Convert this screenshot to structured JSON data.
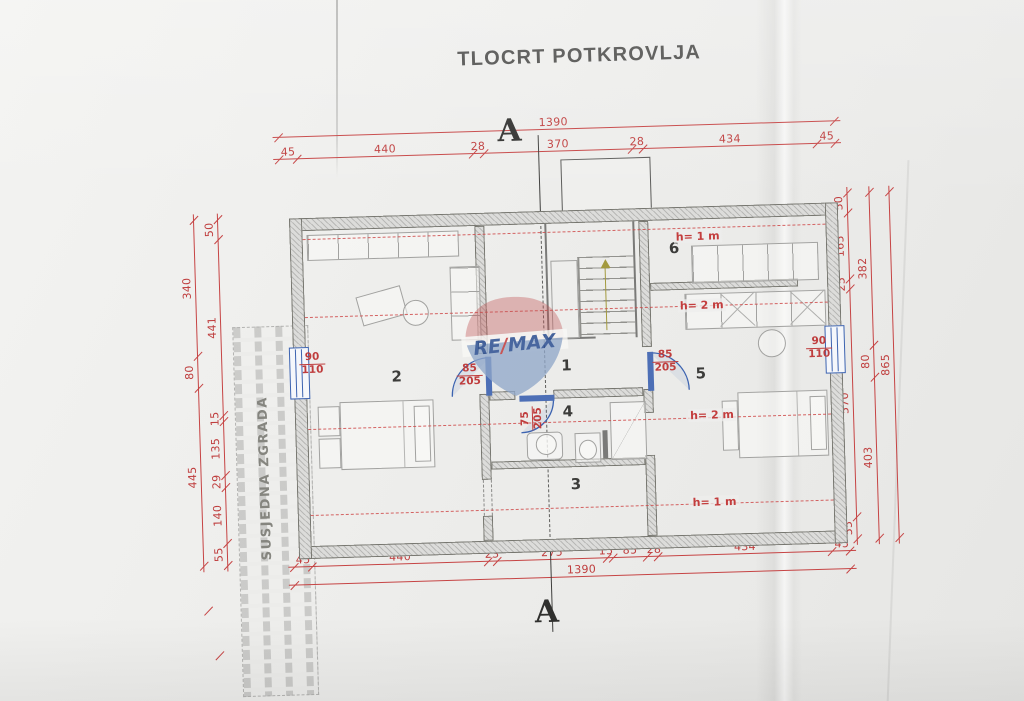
{
  "title": "TLOCRT POTKROVLJA",
  "section": {
    "top": "A",
    "bottom": "A"
  },
  "neighbor": {
    "label": "SUSJEDNA ZGRADA"
  },
  "watermark": {
    "re": "RE",
    "slash": "/",
    "max": "MAX"
  },
  "rooms": {
    "r1": "1",
    "r2": "2",
    "r3": "3",
    "r4": "4",
    "r5": "5",
    "r6": "6"
  },
  "heights": {
    "h1": "h= 1 m",
    "h2": "h= 2 m",
    "h3": "h= 2 m",
    "h4": "h= 1 m"
  },
  "dims": {
    "top": {
      "total": "1390",
      "segments": [
        "45",
        "440",
        "28",
        "370",
        "28",
        "434",
        "45"
      ]
    },
    "bottom": {
      "total": "1390",
      "segments": [
        "45",
        "440",
        "23",
        "275",
        "15",
        "85",
        "28",
        "434",
        "45"
      ]
    },
    "left": {
      "outer": [
        "340",
        "80",
        "445"
      ],
      "inner": [
        "50",
        "441",
        "15",
        "135",
        "29",
        "140",
        "55"
      ]
    },
    "right": {
      "inner": [
        "50",
        "165",
        "25",
        "570",
        "55"
      ],
      "middle": [
        "382",
        "80",
        "403"
      ],
      "total": "865"
    }
  },
  "openings": {
    "window_left": {
      "w": "90",
      "h": "110"
    },
    "window_right": {
      "w": "90",
      "h": "110"
    },
    "door_room2": {
      "w": "85",
      "h": "205"
    },
    "door_room5": {
      "w": "85",
      "h": "205"
    },
    "door_room4": {
      "w": "75",
      "h": "205"
    }
  },
  "colors": {
    "dimension_red": "#c64444",
    "opening_blue": "#3c63b0",
    "wall_fill": "#dcdcda",
    "paper": "#ececea",
    "remax_blue": "#8fa6c9",
    "remax_red": "#c05454"
  }
}
